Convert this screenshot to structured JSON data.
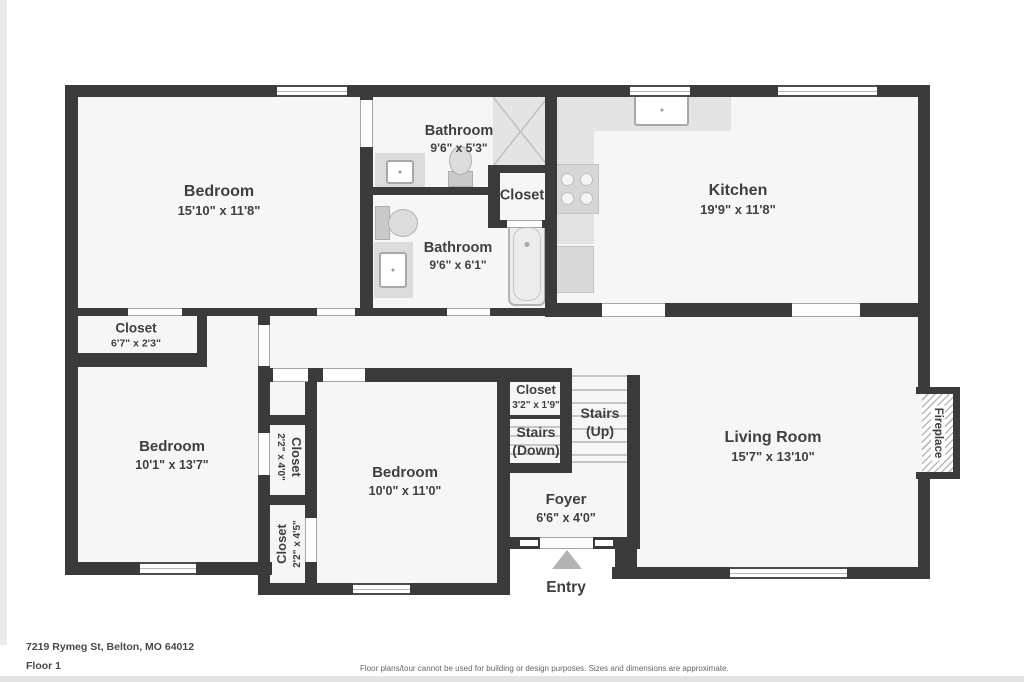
{
  "plan": {
    "rooms": {
      "bedroom1": {
        "name": "Bedroom",
        "dims": "15'10\" x 11'8\""
      },
      "bathroom1": {
        "name": "Bathroom",
        "dims": "9'6\" x 5'3\""
      },
      "bathroom2": {
        "name": "Bathroom",
        "dims": "9'6\" x 6'1\""
      },
      "closet_bath": {
        "name": "Closet"
      },
      "kitchen": {
        "name": "Kitchen",
        "dims": "19'9\" x 11'8\""
      },
      "closet_hall": {
        "name": "Closet",
        "dims": "6'7\" x 2'3\""
      },
      "bedroom2": {
        "name": "Bedroom",
        "dims": "10'1\" x 13'7\""
      },
      "closet_a": {
        "name": "Closet",
        "dims": "2'2\" x 4'0\""
      },
      "closet_b": {
        "name": "Closet",
        "dims": "2'2\" x 4'5\""
      },
      "bedroom3": {
        "name": "Bedroom",
        "dims": "10'0\" x 11'0\""
      },
      "closet_stairs": {
        "name": "Closet",
        "dims": "3'2\" x 1'9\""
      },
      "stairs_down": {
        "name": "Stairs",
        "dims": "(Down)"
      },
      "stairs_up": {
        "name": "Stairs",
        "dims": "(Up)"
      },
      "foyer": {
        "name": "Foyer",
        "dims": "6'6\" x 4'0\""
      },
      "living": {
        "name": "Living Room",
        "dims": "15'7\" x 13'10\""
      },
      "fireplace": {
        "name": "Fireplace"
      },
      "entry": {
        "name": "Entry"
      }
    },
    "footer": {
      "address": "7219 Rymeg St, Belton, MO 64012",
      "floor": "Floor 1",
      "disclaimer": "Floor plans/tour cannot be used for building or design purposes. Sizes and dimensions are approximate."
    },
    "colors": {
      "wall": "#3b3b3b",
      "floor": "#f6f6f6",
      "fixture": "#d9d9d9",
      "text": "#3f3f3f"
    }
  }
}
